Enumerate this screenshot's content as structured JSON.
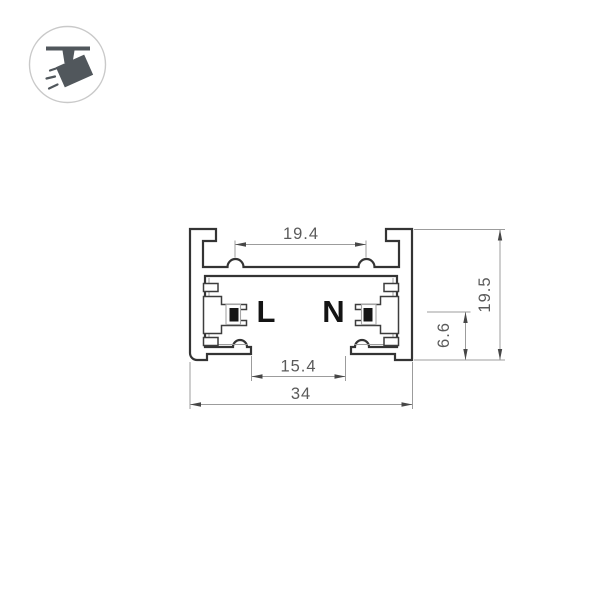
{
  "icon": {
    "name": "track-spotlight-icon"
  },
  "drawing": {
    "type": "track-profile-cross-section",
    "conductor_labels": {
      "live": "L",
      "neutral": "N"
    },
    "dimensions": {
      "top_width": "19.4",
      "bottom_opening": "15.4",
      "overall_width": "34",
      "conductor_height": "6.6",
      "overall_height": "19.5"
    }
  },
  "colors": {
    "background": "#ffffff",
    "outline": "#343434",
    "thin_lines": "#9c9c9c",
    "dimension_text": "#5a5a5a",
    "conductor": "#161616",
    "icon": "#51575c",
    "icon_circle_stroke": "#c9c9c9"
  }
}
